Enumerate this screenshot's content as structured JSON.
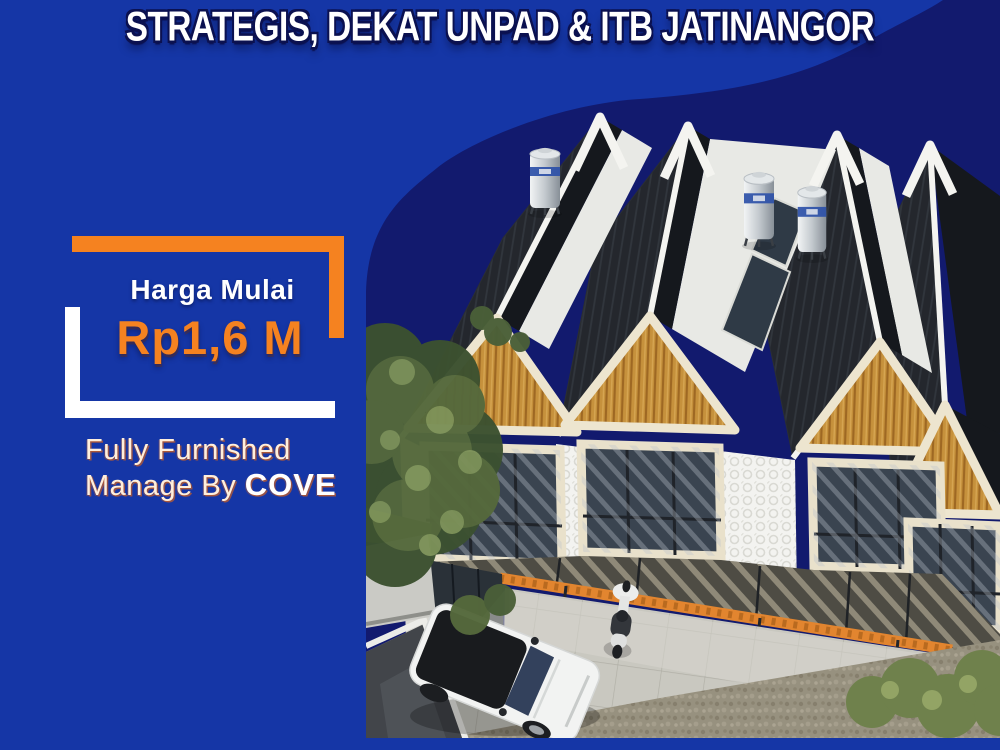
{
  "headline": "STRATEGIS, DEKAT UNPAD & ITB JATINANGOR",
  "price": {
    "label": "Harga Mulai",
    "value": "Rp1,6 M"
  },
  "features": {
    "line1": "Fully Furnished",
    "line2_prefix": "Manage By ",
    "line2_brand": "COVE"
  },
  "colors": {
    "background_blue": "#1536A6",
    "navy_blob": "#121A6E",
    "accent_orange": "#F58220",
    "text_white": "#FFFFFF",
    "roof_dark": "#24272D",
    "wood_gable": "#C6913C"
  }
}
